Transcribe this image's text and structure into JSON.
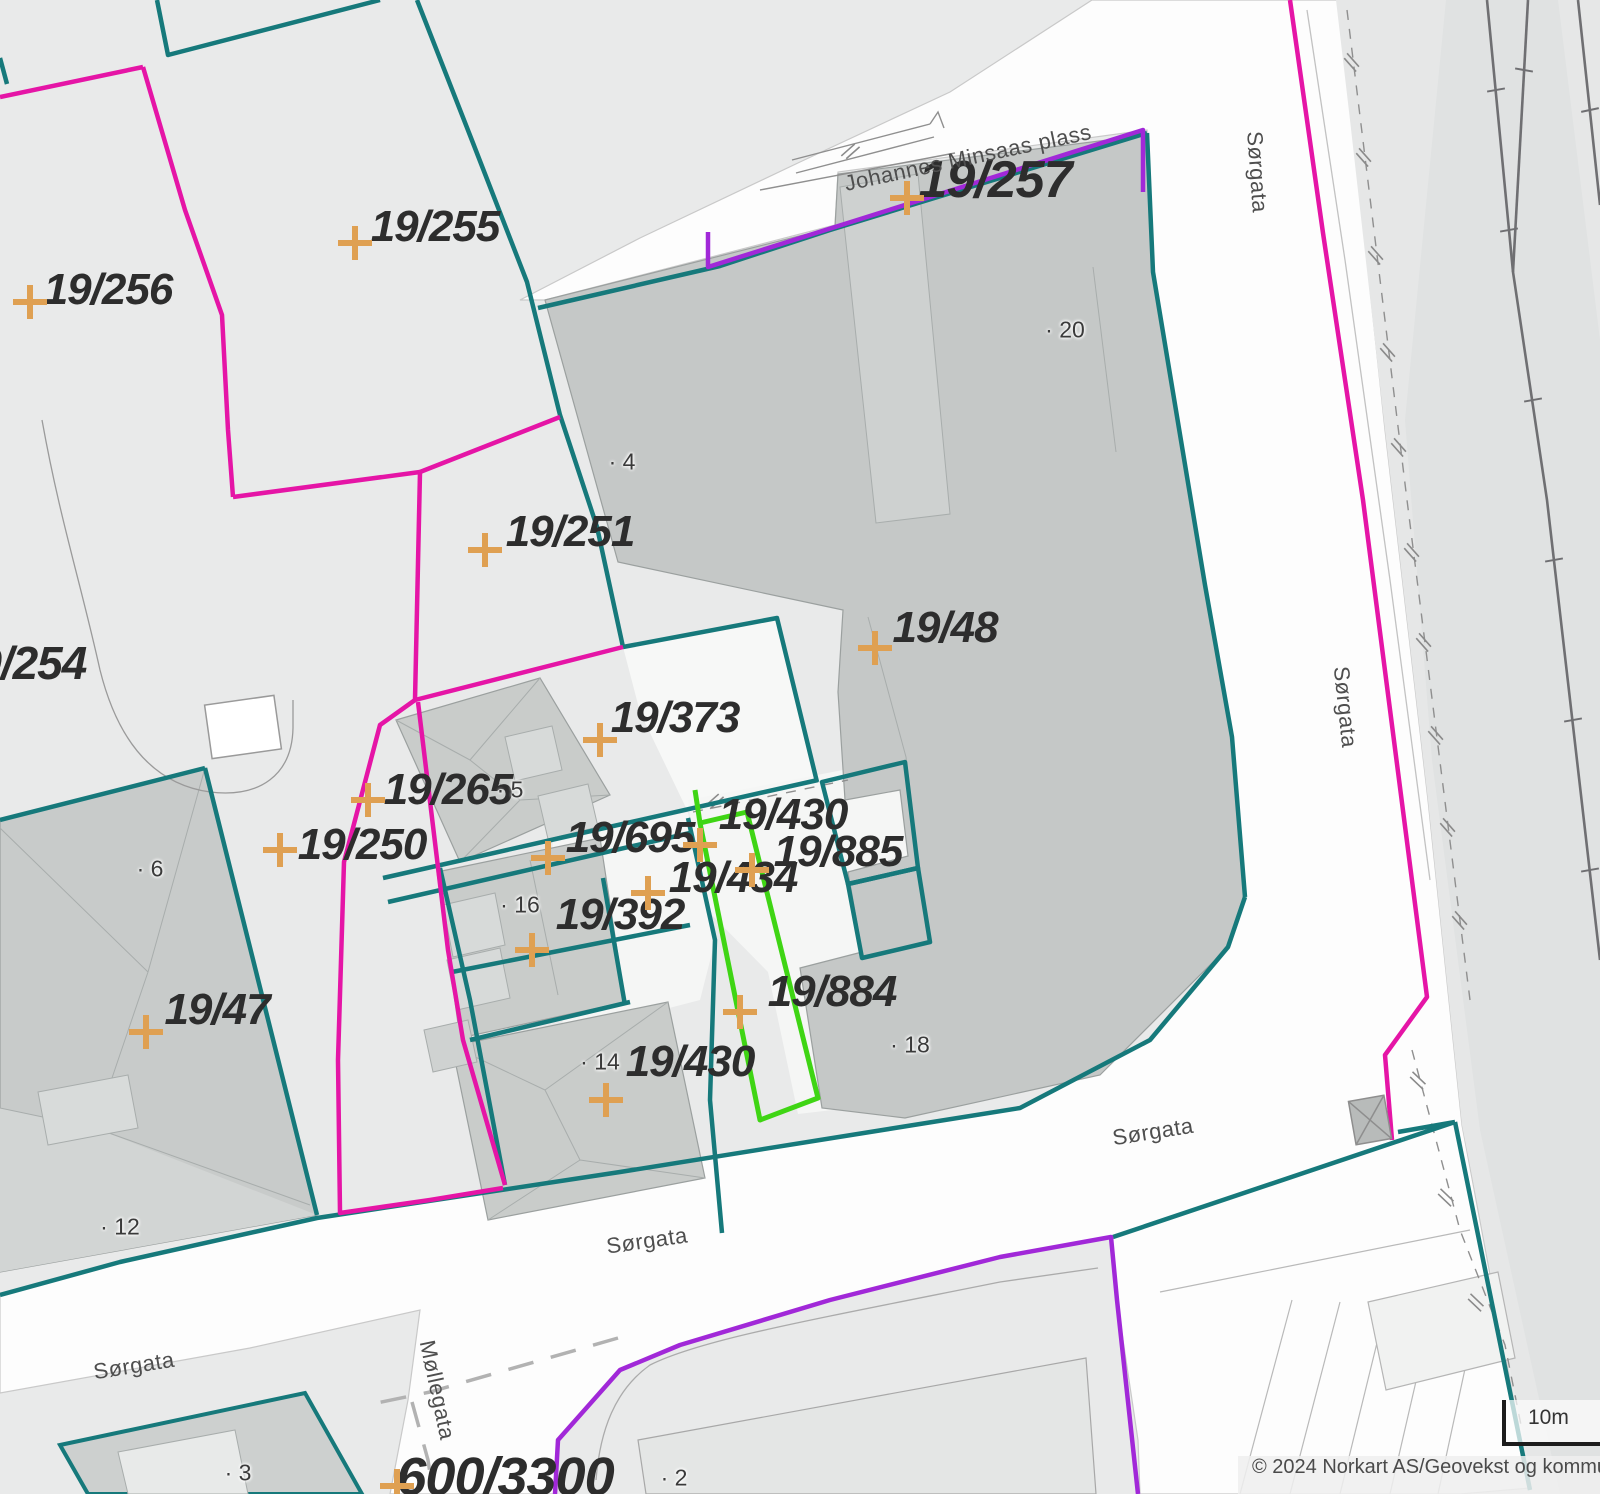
{
  "map": {
    "copyright": "© 2024 Norkart AS/Geovekst og kommunene",
    "scale_label": "10m",
    "colors": {
      "background": "#E9EAEA",
      "road": "#FDFDFD",
      "building": "#C6C9C8",
      "parcel_boundary_teal": "#16797B",
      "parcel_boundary_magenta": "#E515A6",
      "parcel_boundary_purple": "#A128D8",
      "parcel_boundary_green": "#3FD514",
      "survey_cross_orange": "#DFA052",
      "label_text": "#2D2D2D",
      "street_text": "#4E4E4E"
    },
    "parcel_labels": [
      {
        "text": "19/256",
        "x": 108,
        "y": 290
      },
      {
        "text": "19/255",
        "x": 435,
        "y": 227
      },
      {
        "text": "19/257",
        "x": 995,
        "y": 180,
        "size": 52
      },
      {
        "text": "19/251",
        "x": 570,
        "y": 532
      },
      {
        "text": "19/254",
        "x": 19,
        "y": 663,
        "size": 46
      },
      {
        "text": "19/48",
        "x": 945,
        "y": 628
      },
      {
        "text": "19/373",
        "x": 675,
        "y": 718
      },
      {
        "text": "19/265",
        "x": 448,
        "y": 790
      },
      {
        "text": "19/250",
        "x": 362,
        "y": 845
      },
      {
        "text": "19/695",
        "x": 630,
        "y": 838
      },
      {
        "text": "19/430",
        "x": 783,
        "y": 815
      },
      {
        "text": "19/885",
        "x": 838,
        "y": 852
      },
      {
        "text": "19/434",
        "x": 733,
        "y": 878
      },
      {
        "text": "19/392",
        "x": 620,
        "y": 915
      },
      {
        "text": "19/47",
        "x": 217,
        "y": 1010
      },
      {
        "text": "19/884",
        "x": 832,
        "y": 992
      },
      {
        "text": "19/430",
        "x": 690,
        "y": 1062
      },
      {
        "text": "600/3300",
        "x": 505,
        "y": 1477,
        "size": 54
      }
    ],
    "street_labels": [
      {
        "text": "Johannes Minsaas plass",
        "x": 968,
        "y": 158,
        "rot": -12
      },
      {
        "text": "Sørgata",
        "x": 1257,
        "y": 172,
        "rot": 86
      },
      {
        "text": "Sørgata",
        "x": 1345,
        "y": 707,
        "rot": 84
      },
      {
        "text": "Sørgata",
        "x": 1153,
        "y": 1132,
        "rot": -9
      },
      {
        "text": "Sørgata",
        "x": 647,
        "y": 1241,
        "rot": -8
      },
      {
        "text": "Sørgata",
        "x": 134,
        "y": 1366,
        "rot": -9
      },
      {
        "text": "Møllegata",
        "x": 437,
        "y": 1390,
        "rot": 78
      }
    ],
    "building_numbers": [
      {
        "text": "· 4",
        "x": 622,
        "y": 462
      },
      {
        "text": "· 20",
        "x": 1065,
        "y": 330
      },
      {
        "text": "· 5",
        "x": 510,
        "y": 790
      },
      {
        "text": "· 6",
        "x": 150,
        "y": 869
      },
      {
        "text": "· 16",
        "x": 520,
        "y": 905
      },
      {
        "text": "· 14",
        "x": 600,
        "y": 1062
      },
      {
        "text": "· 12",
        "x": 120,
        "y": 1227
      },
      {
        "text": "· 18",
        "x": 910,
        "y": 1045
      },
      {
        "text": "· 3",
        "x": 238,
        "y": 1473
      },
      {
        "text": "· 2",
        "x": 674,
        "y": 1478
      }
    ],
    "survey_crosses": [
      {
        "x": 30,
        "y": 302
      },
      {
        "x": 355,
        "y": 243
      },
      {
        "x": 907,
        "y": 198
      },
      {
        "x": 485,
        "y": 550
      },
      {
        "x": 875,
        "y": 648
      },
      {
        "x": 600,
        "y": 740
      },
      {
        "x": 368,
        "y": 800
      },
      {
        "x": 280,
        "y": 850
      },
      {
        "x": 548,
        "y": 858
      },
      {
        "x": 700,
        "y": 845
      },
      {
        "x": 752,
        "y": 870
      },
      {
        "x": 648,
        "y": 893
      },
      {
        "x": 532,
        "y": 950
      },
      {
        "x": 146,
        "y": 1032
      },
      {
        "x": 740,
        "y": 1012
      },
      {
        "x": 606,
        "y": 1100
      },
      {
        "x": 397,
        "y": 1486
      }
    ]
  }
}
